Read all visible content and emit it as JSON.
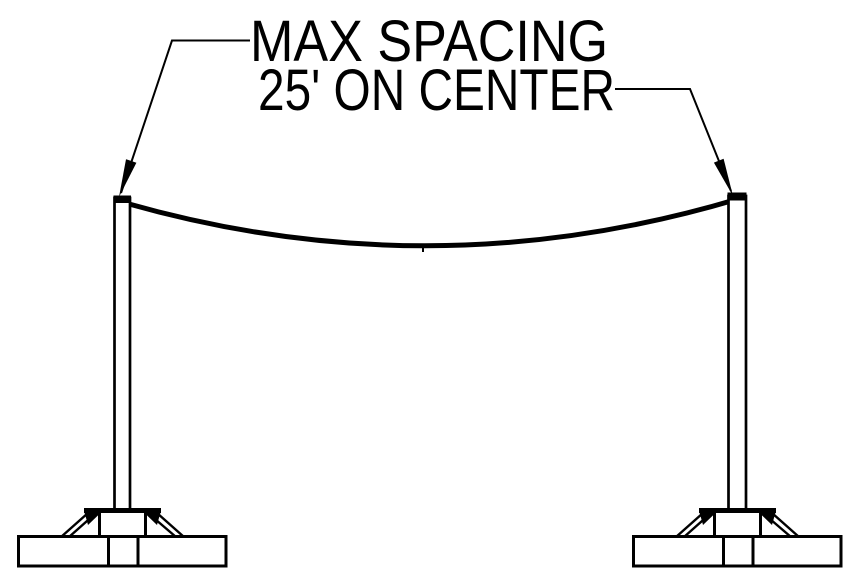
{
  "diagram": {
    "callout": {
      "line1": "MAX SPACING",
      "line2": "25' ON CENTER"
    },
    "colors": {
      "ink": "#000000",
      "background": "#ffffff"
    }
  }
}
